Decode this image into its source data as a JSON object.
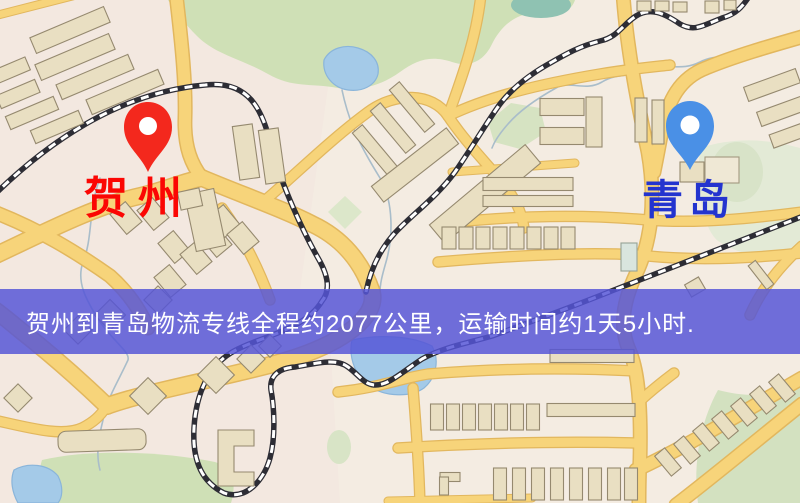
{
  "route": {
    "origin": {
      "name": "贺州",
      "pin_icon": "red-map-pin",
      "pin_color": "#f3281d",
      "label_color": "#fb0603"
    },
    "destination": {
      "name": "青岛",
      "pin_icon": "blue-map-pin",
      "pin_color": "#4a90e6",
      "label_color": "#2434cf"
    },
    "banner": {
      "text": "贺州到青岛物流专线全程约2077公里，运输时间约1天5小时.",
      "distance_text": "约2077公里",
      "duration_text": "约1天5小时",
      "background_color": "#5555d6",
      "text_color": "#ffffff"
    }
  },
  "map": {
    "style": "street-map",
    "colors": {
      "background": "#f4ece2",
      "road": "#f7d47a",
      "road_casing": "#e2b75e",
      "building": "#e9dfc2",
      "building_outline": "#95896f",
      "park": "#cfe0b6",
      "water": "#a4cae8",
      "railway": "#2d2d35"
    }
  }
}
